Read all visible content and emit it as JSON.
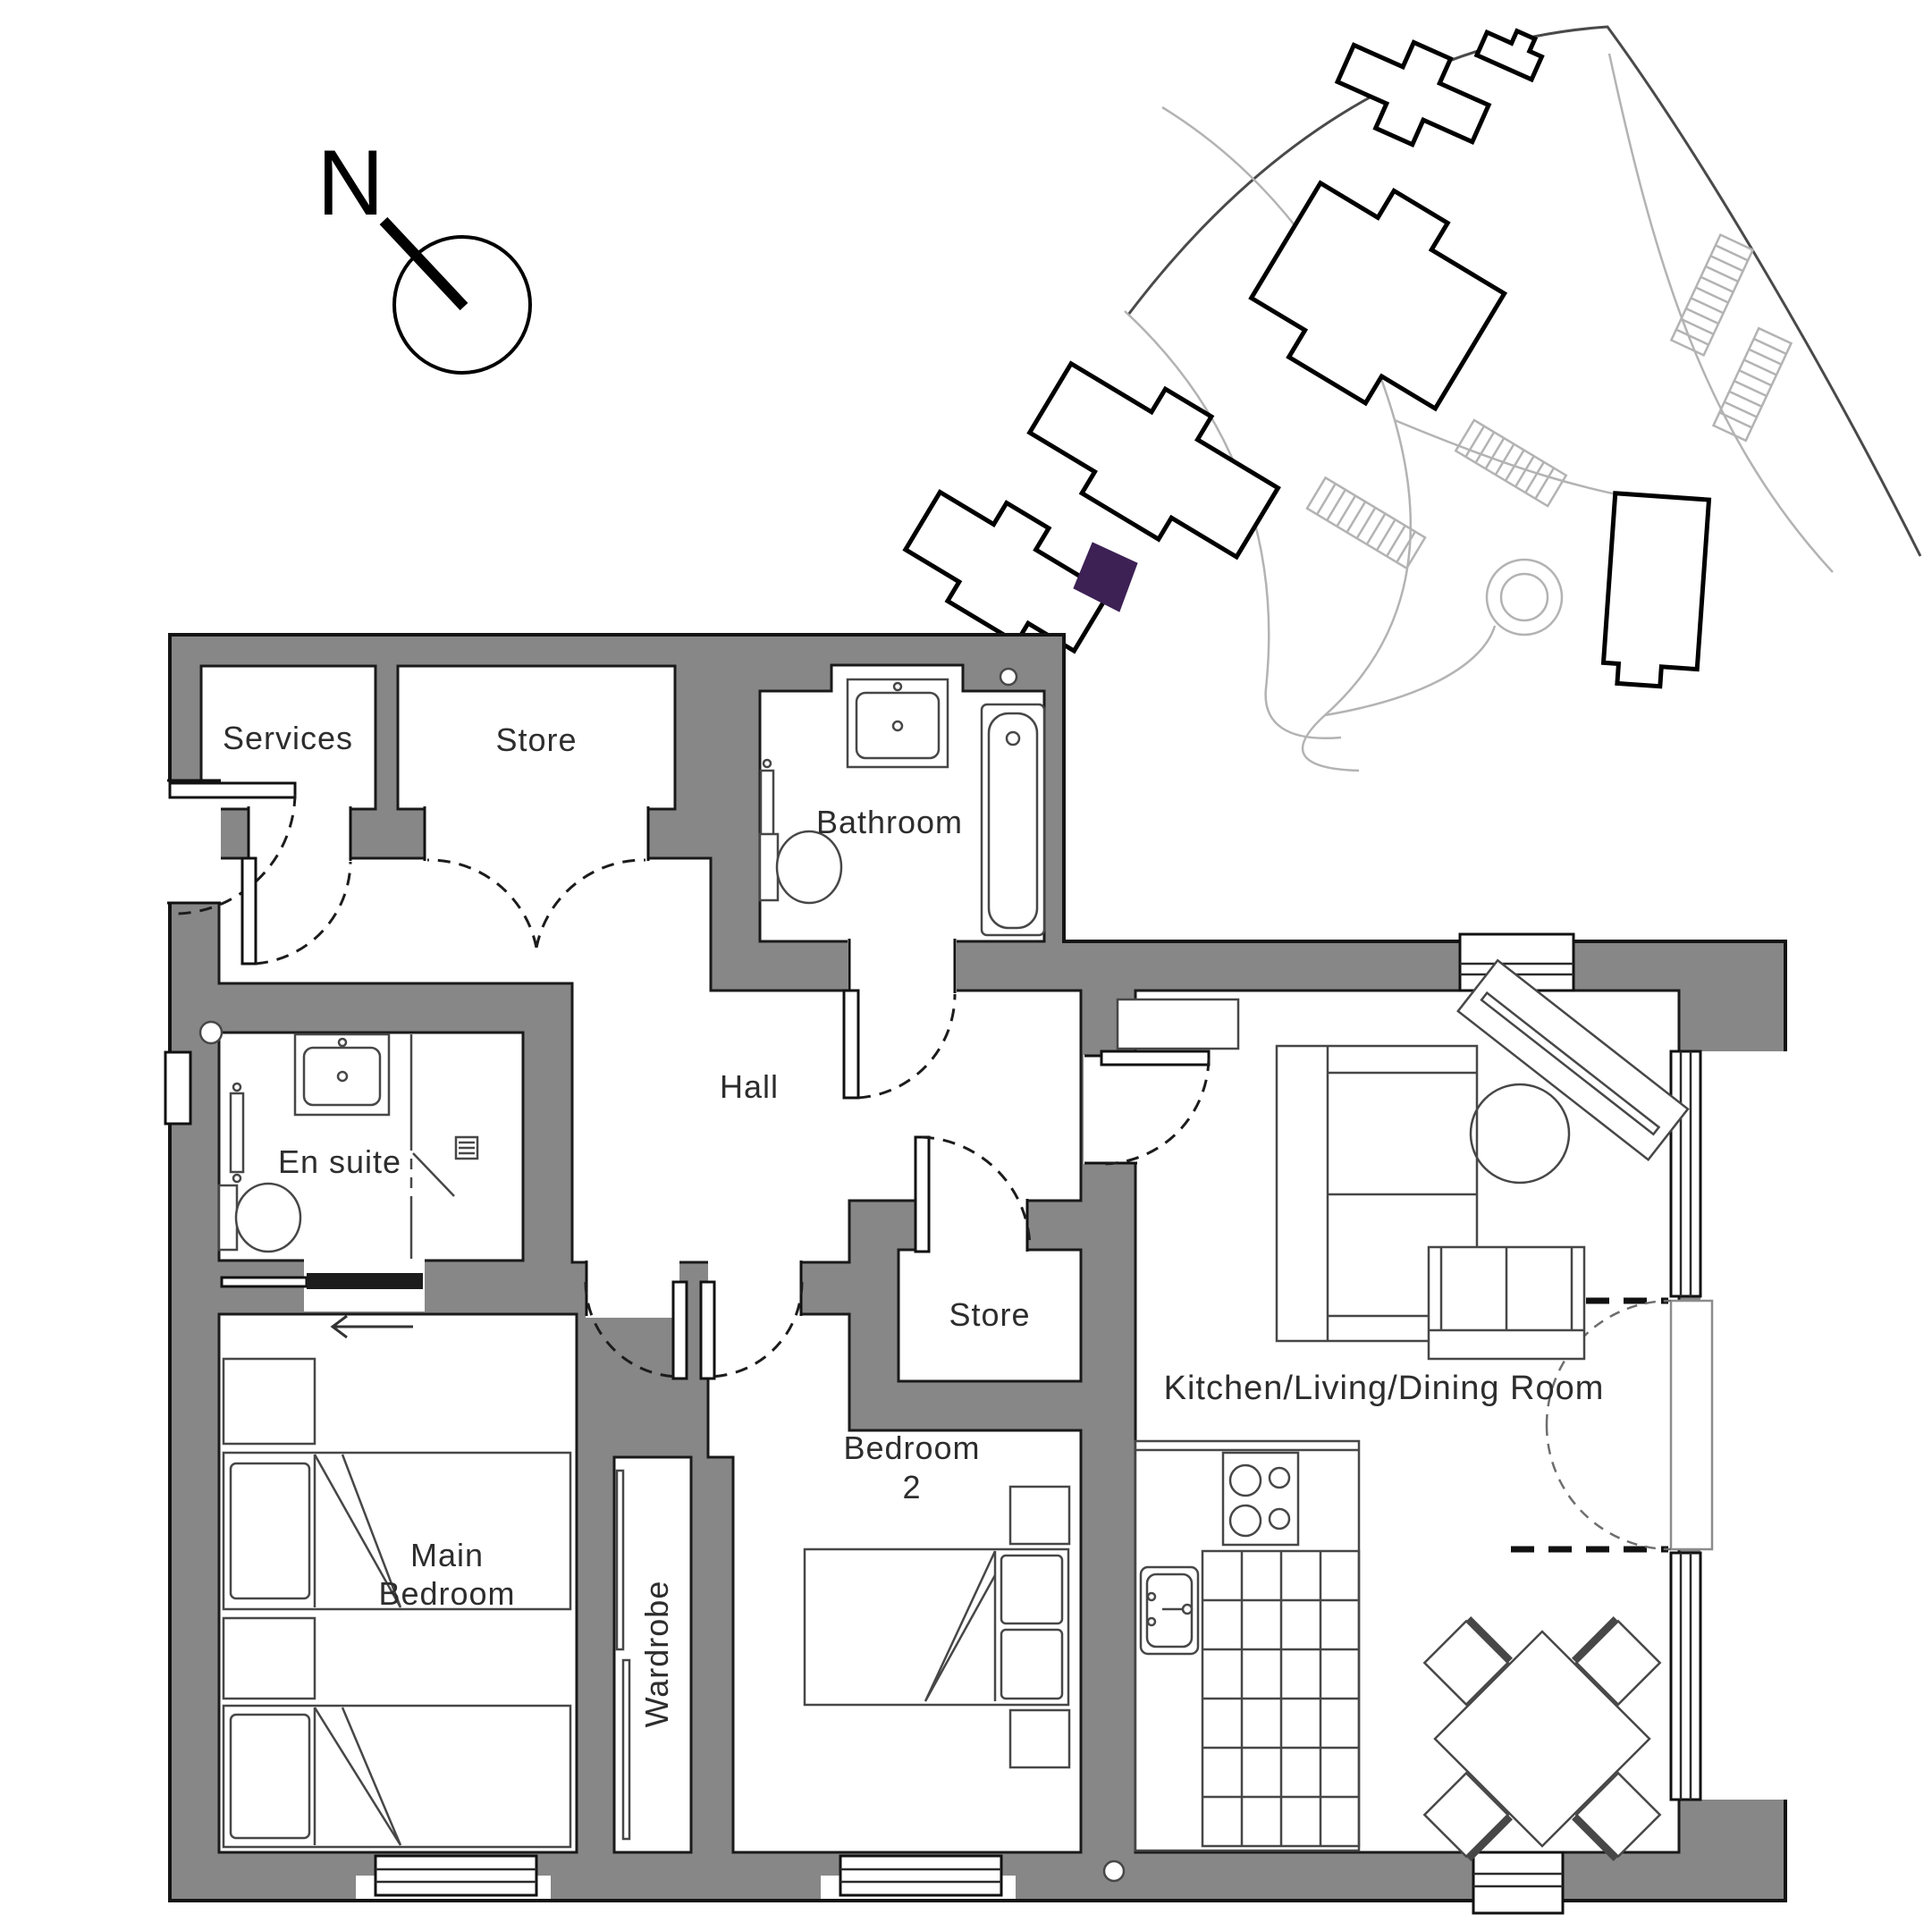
{
  "page": {
    "type": "apartment-floorplan"
  },
  "compass": {
    "north_label": "N"
  },
  "labels": {
    "services": "Services",
    "store_top": "Store",
    "bathroom": "Bathroom",
    "hall": "Hall",
    "en_suite": "En suite",
    "store_hall": "Store",
    "main_bedroom_line1": "Main",
    "main_bedroom_line2": "Bedroom",
    "wardrobe": "Wardrobe",
    "bedroom2_line1": "Bedroom",
    "bedroom2_line2": "2",
    "kitchen_living_dining": "Kitchen/Living/Dining Room"
  },
  "colors": {
    "wall": "#878787",
    "outline": "#141414",
    "furniture": "#474747",
    "highlight": "#3d2155",
    "site_line": "#b3b3b3"
  }
}
